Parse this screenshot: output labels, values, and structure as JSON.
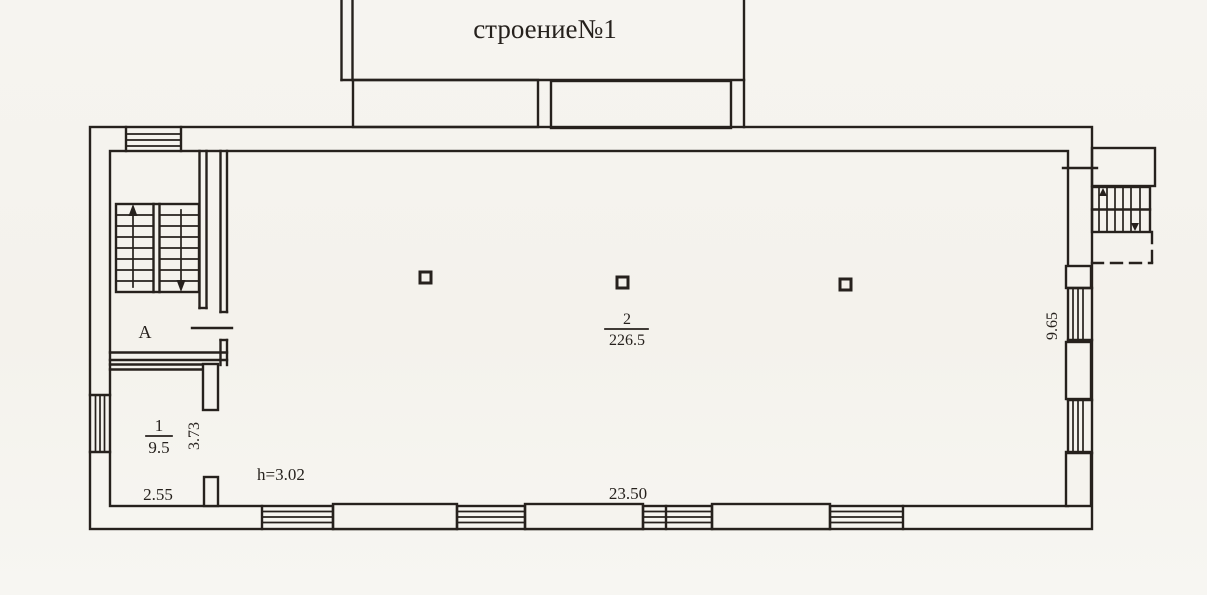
{
  "building": {
    "label": "строение№1"
  },
  "rooms": {
    "stairwell_label": "A",
    "room1": {
      "number": "1",
      "area": "9.5"
    },
    "hall": {
      "number": "2",
      "area": "226.5"
    }
  },
  "dimensions": {
    "room1_width": "2.55",
    "room1_wall_depth": "3.73",
    "ceiling_height": "h=3.02",
    "south_wall_length": "23.50",
    "east_wall_length": "9.65"
  },
  "colors": {
    "paper": "#f5f3ee",
    "ink": "#26211d"
  }
}
